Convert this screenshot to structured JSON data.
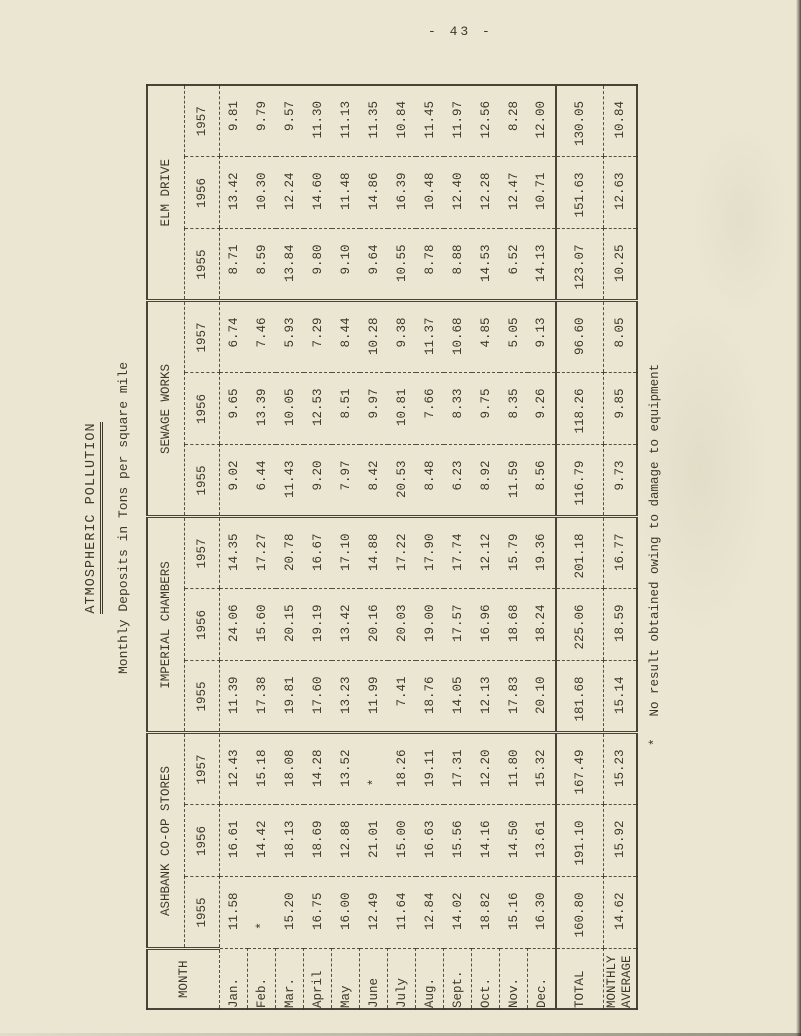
{
  "page_number": "- 43 -",
  "title": "ATMOSPHERIC POLLUTION",
  "subtitle": "Monthly Deposits in Tons per square mile",
  "footnote": {
    "marker": "*",
    "text": "No result obtained owing to damage to equipment"
  },
  "colors": {
    "paper": "#eae6d2",
    "ink": "#3c382c"
  },
  "table": {
    "month_col_header": "MONTH",
    "groups": [
      {
        "name": "ASHBANK CO-OP STORES",
        "years": [
          "1955",
          "1956",
          "1957"
        ]
      },
      {
        "name": "IMPERIAL CHAMBERS",
        "years": [
          "1955",
          "1956",
          "1957"
        ]
      },
      {
        "name": "SEWAGE WORKS",
        "years": [
          "1955",
          "1956",
          "1957"
        ]
      },
      {
        "name": "ELM DRIVE",
        "years": [
          "1955",
          "1956",
          "1957"
        ]
      }
    ],
    "rows": [
      {
        "month": "Jan.",
        "values": [
          "11.58",
          "16.61",
          "12.43",
          "11.39",
          "24.06",
          "14.35",
          "9.02",
          "9.65",
          "6.74",
          "8.71",
          "13.42",
          "9.81"
        ]
      },
      {
        "month": "Feb.",
        "values": [
          "*",
          "14.42",
          "15.18",
          "17.38",
          "15.60",
          "17.27",
          "6.44",
          "13.39",
          "7.46",
          "8.59",
          "10.30",
          "9.79"
        ]
      },
      {
        "month": "Mar.",
        "values": [
          "15.20",
          "18.13",
          "18.08",
          "19.81",
          "20.15",
          "20.78",
          "11.43",
          "10.05",
          "5.93",
          "13.84",
          "12.24",
          "9.57"
        ]
      },
      {
        "month": "April",
        "values": [
          "16.75",
          "18.69",
          "14.28",
          "17.60",
          "19.19",
          "16.67",
          "9.20",
          "12.53",
          "7.29",
          "9.80",
          "14.60",
          "11.30"
        ]
      },
      {
        "month": "May",
        "values": [
          "16.00",
          "12.88",
          "13.52",
          "13.23",
          "13.42",
          "17.10",
          "7.97",
          "8.51",
          "8.44",
          "9.10",
          "11.48",
          "11.13"
        ]
      },
      {
        "month": "June",
        "values": [
          "12.49",
          "21.01",
          "*",
          "11.99",
          "20.16",
          "14.88",
          "8.42",
          "9.97",
          "10.28",
          "9.64",
          "14.86",
          "11.35"
        ]
      },
      {
        "month": "July",
        "values": [
          "11.64",
          "15.00",
          "18.26",
          "7.41",
          "20.03",
          "17.22",
          "20.53",
          "10.81",
          "9.38",
          "10.55",
          "16.39",
          "10.84"
        ]
      },
      {
        "month": "Aug.",
        "values": [
          "12.84",
          "16.63",
          "19.11",
          "18.76",
          "19.00",
          "17.90",
          "8.48",
          "7.66",
          "11.37",
          "8.78",
          "10.48",
          "11.45"
        ]
      },
      {
        "month": "Sept.",
        "values": [
          "14.02",
          "15.56",
          "17.31",
          "14.05",
          "17.57",
          "17.74",
          "6.23",
          "8.33",
          "10.68",
          "8.88",
          "12.40",
          "11.97"
        ]
      },
      {
        "month": "Oct.",
        "values": [
          "18.82",
          "14.16",
          "12.20",
          "12.13",
          "16.96",
          "12.12",
          "8.92",
          "9.75",
          "4.85",
          "14.53",
          "12.28",
          "12.56"
        ]
      },
      {
        "month": "Nov.",
        "values": [
          "15.16",
          "14.50",
          "11.80",
          "17.83",
          "18.68",
          "15.79",
          "11.59",
          "8.35",
          "5.05",
          "6.52",
          "12.47",
          "8.28"
        ]
      },
      {
        "month": "Dec.",
        "values": [
          "16.30",
          "13.61",
          "15.32",
          "20.10",
          "18.24",
          "19.36",
          "8.56",
          "9.26",
          "9.13",
          "14.13",
          "10.71",
          "12.00"
        ]
      }
    ],
    "total_row": {
      "label": "TOTAL",
      "values": [
        "160.80",
        "191.10",
        "167.49",
        "181.68",
        "225.06",
        "201.18",
        "116.79",
        "118.26",
        "96.60",
        "123.07",
        "151.63",
        "130.05"
      ]
    },
    "average_row": {
      "label": "MONTHLY AVERAGE",
      "values": [
        "14.62",
        "15.92",
        "15.23",
        "15.14",
        "18.59",
        "16.77",
        "9.73",
        "9.85",
        "8.05",
        "10.25",
        "12.63",
        "10.84"
      ]
    }
  }
}
